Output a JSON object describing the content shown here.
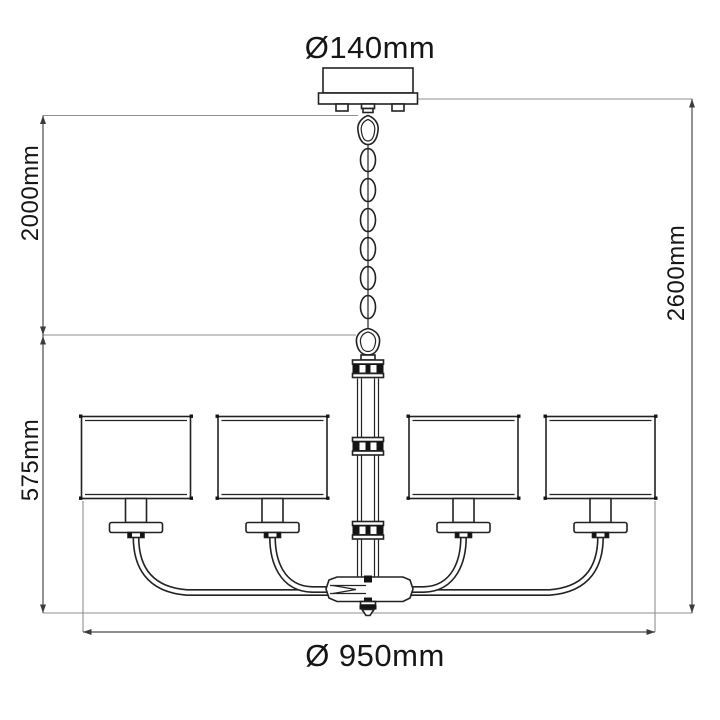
{
  "drawing": {
    "type": "technical dimension drawing",
    "subject": "4-light chandelier with chain suspension, drum shades and scroll arms",
    "labels": {
      "canopy_diameter": "Ø140mm",
      "suspension_height": "2000mm",
      "total_height": "2600mm",
      "fixture_height": "575mm",
      "fixture_diameter": "Ø 950mm"
    },
    "colors": {
      "background": "#ffffff",
      "outline": "#222222",
      "dimension_line": "#4a4a4a",
      "extension_line": "#8f8f8f",
      "text": "#161616"
    },
    "counts": {
      "lamp_shades": 4,
      "chain_links": 6
    }
  }
}
